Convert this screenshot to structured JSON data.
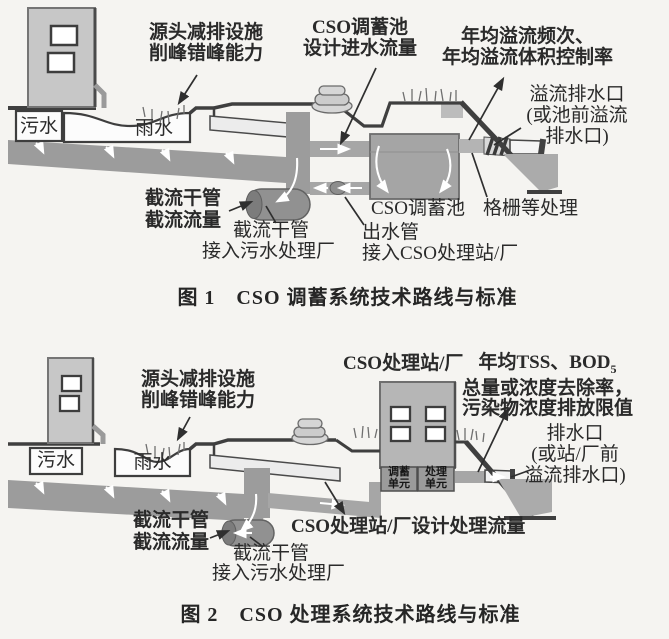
{
  "palette": {
    "ink": "#3f3f3f",
    "pipe_gray": "#9c9c9c",
    "tank_gray": "#a5a5a5",
    "building_gray": "#c7c7c7",
    "water_gray": "#ababab",
    "background": "#f5f4f1"
  },
  "fig1": {
    "caption": "图 1　CSO 调蓄系统技术路线与标准",
    "source_1": "源头减排设施",
    "source_2": "削峰错峰能力",
    "inflow_1": "CSO调蓄池",
    "inflow_2": "设计进水流量",
    "overflow_1": "年均溢流频次、",
    "overflow_2": "年均溢流体积控制率",
    "outfall_1": "溢流排水口",
    "outfall_2": "(或池前溢流",
    "outfall_3": "排水口)",
    "sewage": "污水",
    "rain": "雨水",
    "intercept_1": "截流干管",
    "intercept_2": "截流流量",
    "intercept_pipe": "截流干管",
    "intercept_dest": "接入污水处理厂",
    "tank_label": "CSO调蓄池",
    "screen_label": "格栅等处理",
    "outpipe": "出水管",
    "outpipe_dest": "接入CSO处理站/厂"
  },
  "fig2": {
    "caption": "图 2　CSO 处理系统技术路线与标准",
    "source_1": "源头减排设施",
    "source_2": "削峰错峰能力",
    "station": "CSO处理站/厂",
    "tss_1a": "年均TSS、BOD",
    "tss_1b": "5",
    "tss_2": "总量或浓度去除率，",
    "tss_3": "污染物浓度排放限值",
    "outfall_1": "排水口",
    "outfall_2": "(或站/厂前",
    "outfall_3": "溢流排水口)",
    "sewage": "污水",
    "rain": "雨水",
    "intercept_1": "截流干管",
    "intercept_2": "截流流量",
    "design_flow": "CSO处理站/厂设计处理流量",
    "intercept_pipe": "截流干管",
    "intercept_dest": "接入污水处理厂",
    "unit1_1": "调蓄",
    "unit1_2": "单元",
    "unit2_1": "处理",
    "unit2_2": "单元"
  }
}
